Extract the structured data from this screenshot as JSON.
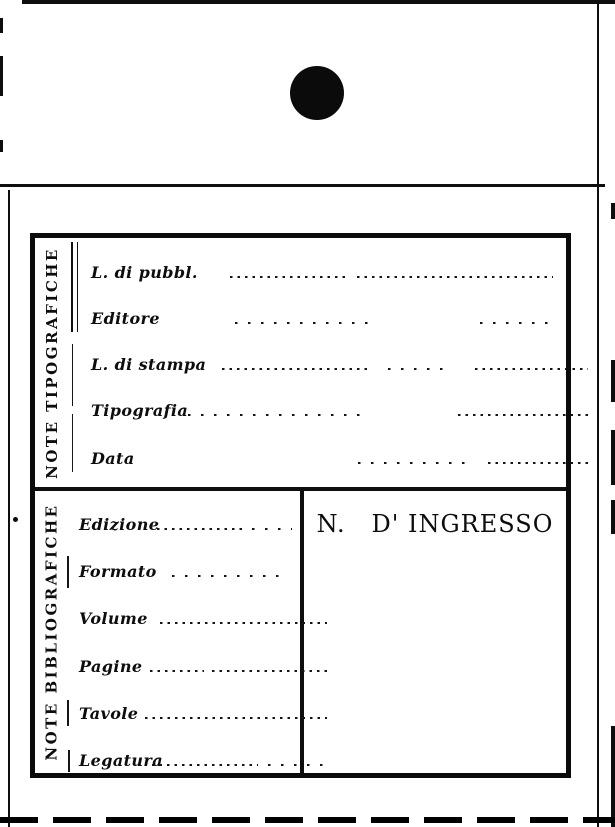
{
  "card": {
    "sections": [
      {
        "side_label": "NOTE TIPOGRAFICHE",
        "fields": [
          "L. di pubbl.",
          "Editore",
          "L. di stampa",
          "Tipografia",
          "Data"
        ]
      },
      {
        "side_label": "NOTE BIBLIOGRAFICHE",
        "fields": [
          "Edizione",
          "Formato",
          "Volume",
          "Pagine",
          "Tavole",
          "Legatura"
        ],
        "ingresso_label": "N.   D' INGRESSO"
      }
    ]
  },
  "colors": {
    "ink": "#0e0e0e",
    "paper": "#ffffff"
  }
}
